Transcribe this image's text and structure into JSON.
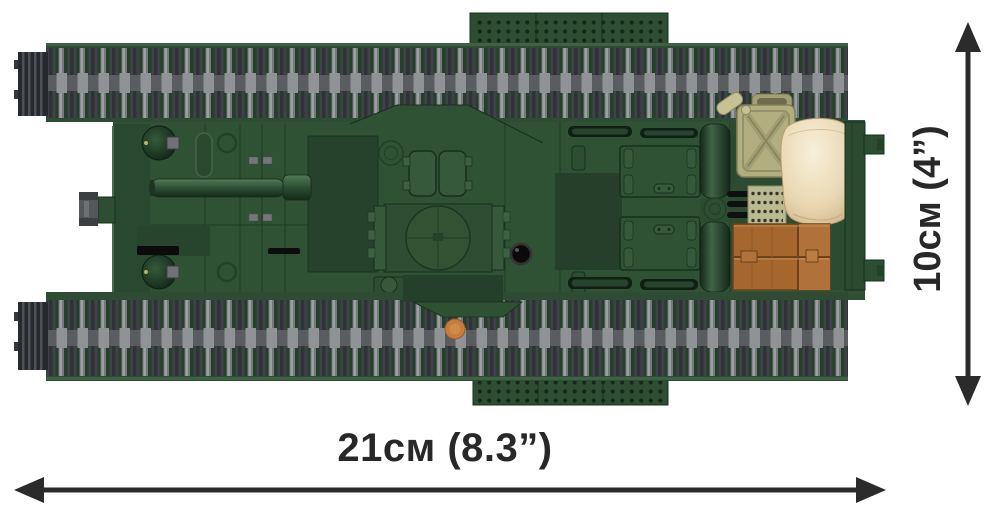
{
  "scene": {
    "description": "Top-down view of a green brick-built military tank model with dimension arrows",
    "background": "#ffffff",
    "view": "top"
  },
  "dimension_labels": {
    "width": "21см (8.3”)",
    "height": "10см (4”)"
  },
  "measurements": {
    "width_cm": 21,
    "width_inches": 8.3,
    "height_cm": 10,
    "height_inches": 4
  },
  "palette": {
    "hull_green": "#2f5134",
    "hull_dark": "#26422c",
    "track_green": "#24402b",
    "track_gray_dark": "#3f4347",
    "track_gray_light": "#8f9395",
    "fuel_canister": "#b2ae80",
    "sandbag": "#eee0c0",
    "crate_brown": "#a5672e",
    "accent_orange": "#c57c3e",
    "annotation": "#2b2b2b"
  },
  "parts": [
    "top-track",
    "bottom-track",
    "hull",
    "gun-barrel",
    "hull-gun-mount",
    "headlight-domes",
    "crew-hatches",
    "turret-ring",
    "periscope",
    "engine-hatches",
    "vent-grilles",
    "fuel-canister",
    "sandbag",
    "wooden-crates",
    "tow-hooks",
    "stowage-plates",
    "orange-stud"
  ]
}
